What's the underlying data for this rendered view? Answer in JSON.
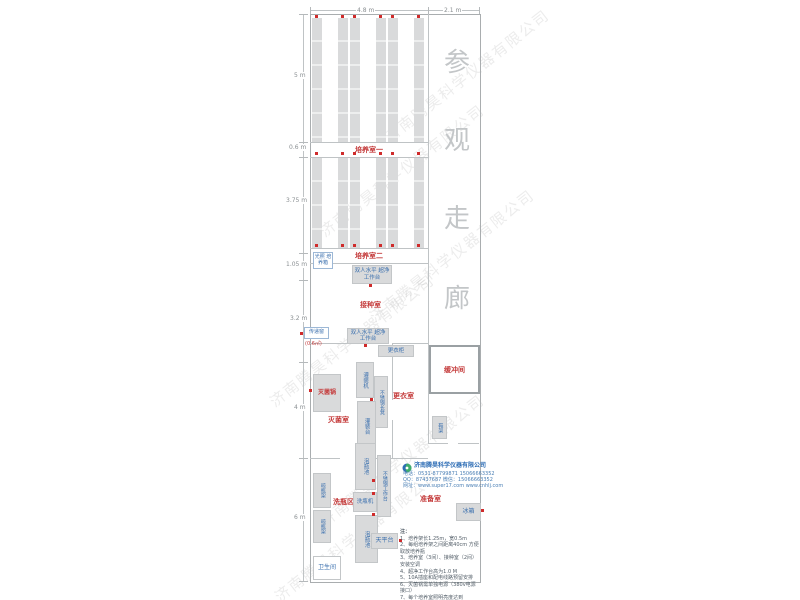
{
  "watermark": {
    "text": "济南腾昊科学仪器有限公司"
  },
  "dimensions": {
    "top": [
      "4.8 m",
      "2.1 m"
    ],
    "left": [
      "5 m",
      "0.6 m",
      "3.75 m",
      "1.05 m",
      "3.2 m",
      "4 m",
      "6 m"
    ]
  },
  "corridor": {
    "chars": [
      "参",
      "观",
      "走",
      "廊"
    ]
  },
  "rooms": {
    "culture1": "培养室一",
    "culture2": "培养室二",
    "inoculation": "接种室",
    "sterilization": "灭菌室",
    "changing": "更衣室",
    "buffer": "缓冲间",
    "washing_area": "洗瓶区",
    "prep": "准备室",
    "toilet": "卫生间"
  },
  "equipment": {
    "light_incubator": "光照 培养箱",
    "clean_bench": "双人水平 超净工作台",
    "pass_window": "传递窗",
    "pass_window_size": "(0.6㎡)",
    "sterilizer": "灭菌锅",
    "filling_machine": "灌装机",
    "filling_table": "灌装台",
    "steel_bench": "不锈钢长凳",
    "wardrobe": "更衣柜",
    "shoe_rack": "鞋架",
    "drying_rack": "晾瓶架",
    "soaking_pool": "泡瓶池",
    "washer": "洗瓶机",
    "steel_worktable": "不锈钢工作台",
    "balance_table": "天平台",
    "fridge": "冰箱"
  },
  "company": {
    "name": "济南腾昊科学仪器有限公司",
    "phone": "电话：0531-87799871  15066663352",
    "qq": "QQ：87437687  微信：15066663352",
    "web": "网址：www.super17.com  www.cnhlj.com"
  },
  "notes": {
    "title": "注：",
    "items": [
      "1、培养架长1.25m，宽0.5m",
      "2、每组培养架之间距离40cm 方便取放培养瓶",
      "3、培养室（3间）、接种室（2间）安装空调",
      "4、超净工作台高为1.0 M",
      "5、10A插座和配电线路预留安排",
      "6、灭菌锅需单独电源（380v电源接口）",
      "7、每个培养室照明亮度达到+150lux左右",
      "8、培养架每层放培养瓶一层，灯管±数量视需求而定。"
    ]
  }
}
